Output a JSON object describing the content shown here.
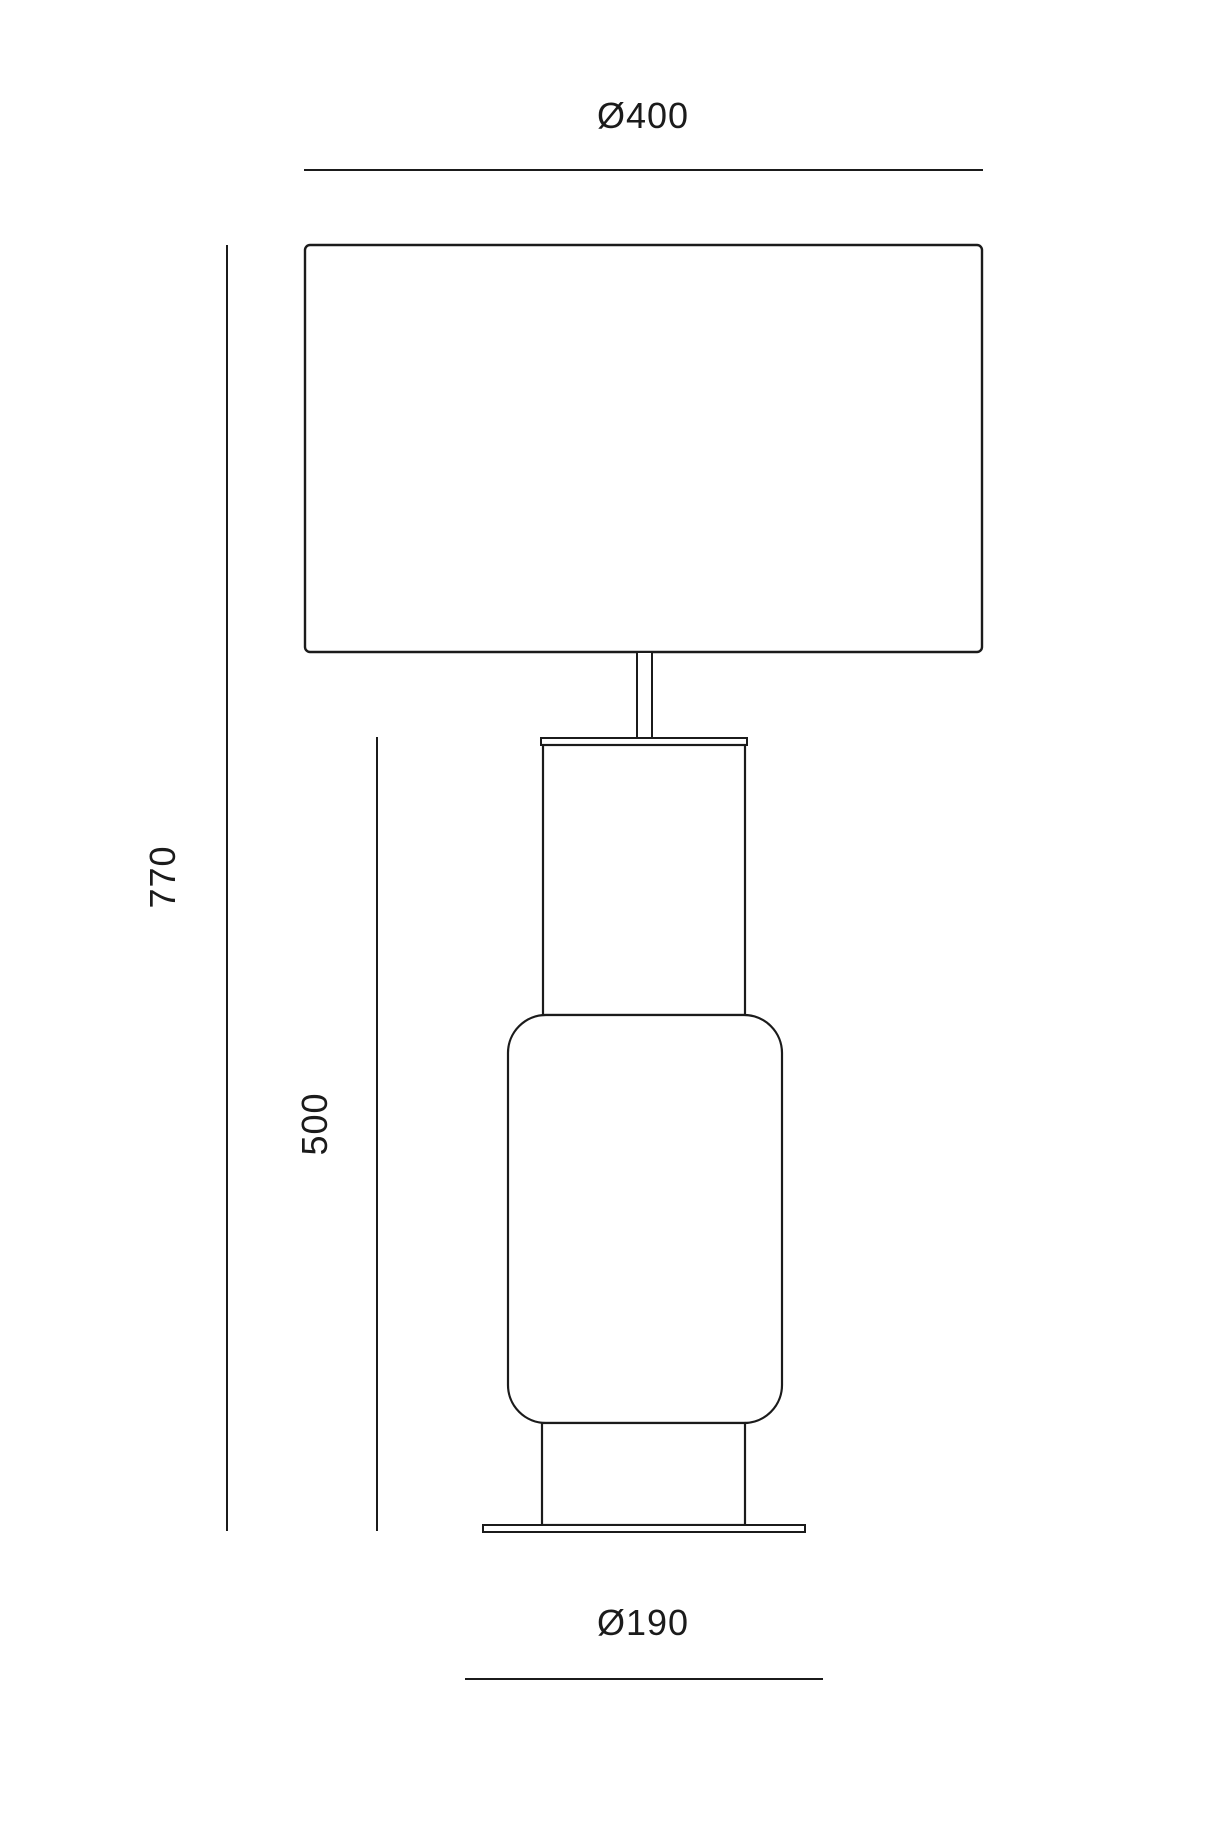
{
  "diagram": {
    "type": "technical-dimension-drawing",
    "subject": "table lamp with rectangular shade and cylindrical glass body",
    "labels": {
      "shade_diameter": "Ø400",
      "total_height": "770",
      "body_height": "500",
      "base_diameter": "Ø190"
    },
    "dimensions": [
      {
        "name": "shade diameter",
        "value": "Ø400",
        "orientation": "horizontal",
        "position": "top"
      },
      {
        "name": "total height",
        "value": "770",
        "orientation": "vertical",
        "position": "far-left"
      },
      {
        "name": "body height",
        "value": "500",
        "orientation": "vertical",
        "position": "inner-left"
      },
      {
        "name": "base diameter",
        "value": "Ø190",
        "orientation": "horizontal",
        "position": "bottom"
      }
    ]
  },
  "colors": {
    "line": "#1b1b1b",
    "background": "#ffffff"
  }
}
